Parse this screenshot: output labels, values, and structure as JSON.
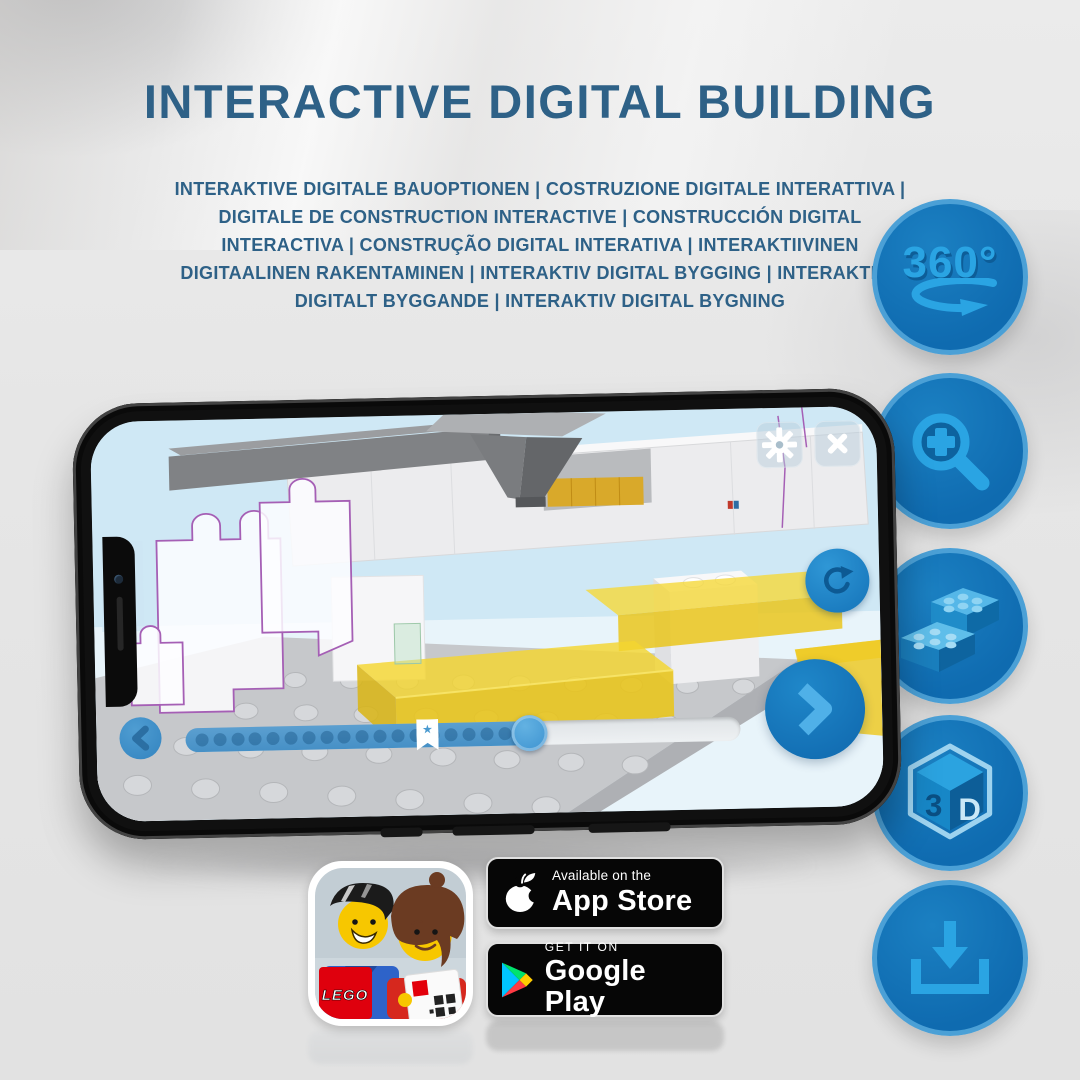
{
  "header": {
    "title": "INTERACTIVE DIGITAL BUILDING",
    "subtitle": "INTERAKTIVE DIGITALE BAUOPTIONEN | COSTRUZIONE DIGITALE INTERATTIVA | DIGITALE DE CONSTRUCTION INTERACTIVE | CONSTRUCCIÓN DIGITAL INTERACTIVA | CONSTRUÇÃO DIGITAL INTERATIVA | INTERAKTIIVINEN DIGITAALINEN RAKENTAMINEN | INTERAKTIV DIGITAL BYGGING | INTERAKTIVT DIGITALT BYGGANDE | INTERAKTIV DIGITAL BYGNING",
    "title_color": "#2e6187"
  },
  "feature_rail": {
    "circle_color": "#106cb1",
    "glyph_color": "#2aa4e3",
    "items": [
      {
        "icon": "360-rotation-icon",
        "label": "360°"
      },
      {
        "icon": "zoom-in-magnifier-icon"
      },
      {
        "icon": "lego-bricks-icon"
      },
      {
        "icon": "3d-cube-icon",
        "label_left": "3",
        "label_right": "D"
      },
      {
        "icon": "download-icon"
      }
    ]
  },
  "phone_app": {
    "controls": {
      "settings": "gear-icon",
      "close": "close-icon",
      "rotate_view": "rotate-icon",
      "previous_step": "chevron-left-icon",
      "next_step": "chevron-right-icon"
    },
    "progress": {
      "percent_complete": 62,
      "bookmark_percent": 44,
      "step_dots": 19,
      "bookmark_icon": "★"
    }
  },
  "badges": {
    "lego_app": {
      "logo_text": "LEGO"
    },
    "app_store": {
      "line1": "Available on the",
      "line2": "App Store"
    },
    "google_play": {
      "line1": "GET IT ON",
      "line2": "Google Play"
    }
  }
}
